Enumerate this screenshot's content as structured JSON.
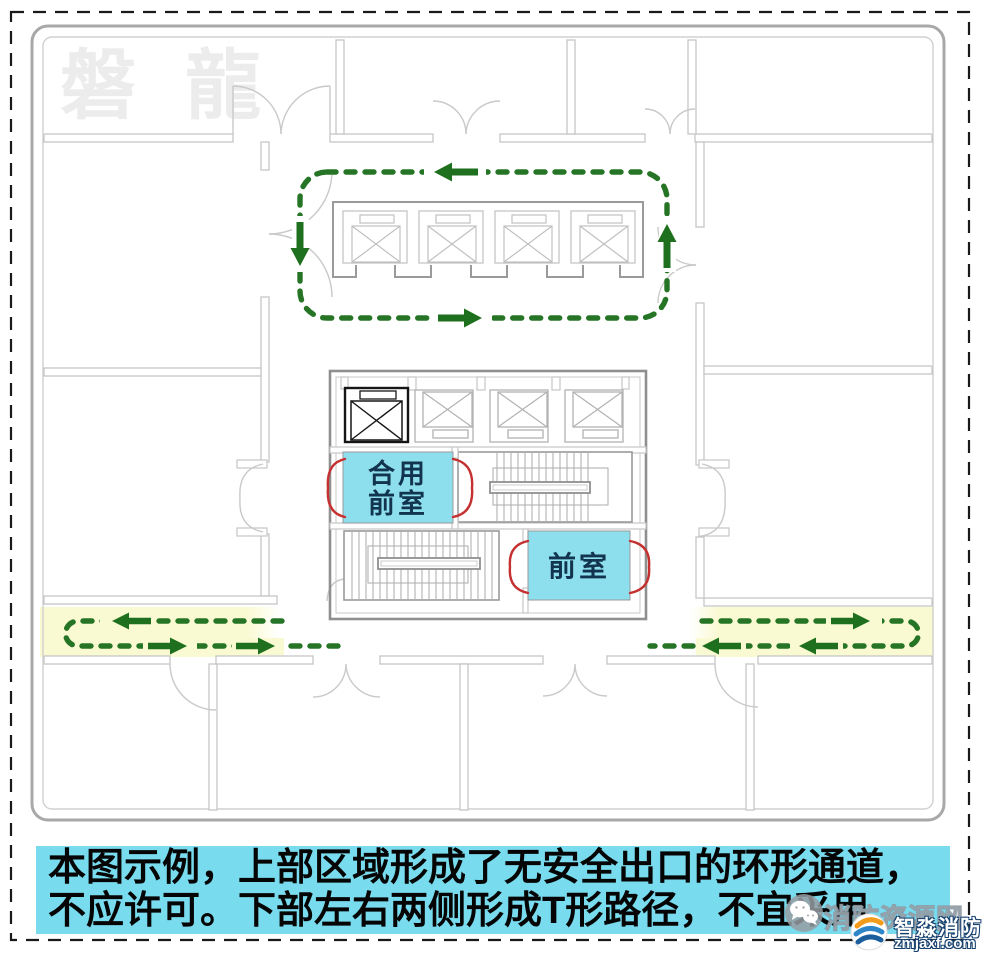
{
  "page": {
    "width": 986,
    "height": 955,
    "kind": "fire evacuation route floor-plan illustration"
  },
  "watermarks": {
    "corner_brand": "磐 龍",
    "site_name": "消防资源网"
  },
  "rooms": {
    "combined_lobby": {
      "line1": "合用",
      "line2": "前室"
    },
    "lobby": {
      "label": "前室"
    }
  },
  "caption": {
    "line1": "本图示例，上部区域形成了无安全出口的环形通道，",
    "line2": "不应许可。下部左右两侧形成T形路径，不宜采用"
  },
  "branding": {
    "name": "智淼消防",
    "domain": "zmjaxf.com"
  },
  "colors": {
    "route_green": "#267526",
    "arrow_green": "#1e6f1e",
    "corridor_highlight_yellow": "#fafad2",
    "lobby_fill_blue": "#8edfee",
    "caption_bg_cyan": "#79dbee",
    "fire_door_red": "#c53030",
    "room_label_navy": "#12344e",
    "wall_gray": "#c6c6c6",
    "core_gray": "#8f8f8f"
  }
}
